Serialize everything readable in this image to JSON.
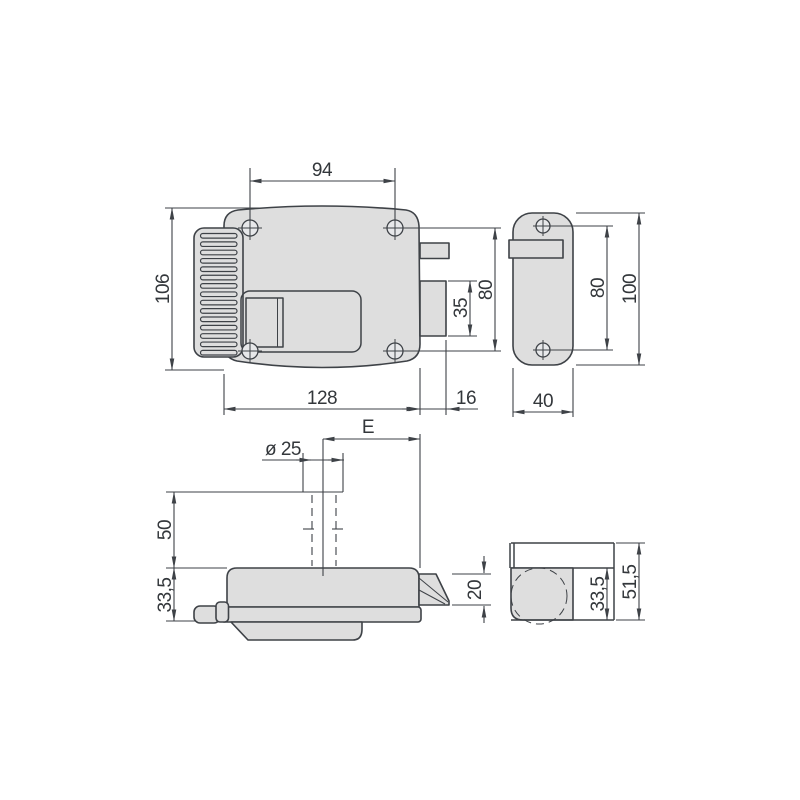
{
  "drawing": {
    "type": "technical-drawing",
    "subject": "electric-rim-lock-with-strike-plate-four-views",
    "colors": {
      "line": "#3e4247",
      "text": "#33373b",
      "body_fill": "#dedede",
      "hole_fill": "#e7e8ea",
      "background": "#ffffff"
    },
    "dimensions": [
      {
        "id": "94",
        "text": "94",
        "x": 322,
        "y": 176,
        "rotated": false
      },
      {
        "id": "106",
        "text": "106",
        "x": 169,
        "y": 289,
        "rotated": true
      },
      {
        "id": "128",
        "text": "128",
        "x": 322,
        "y": 404,
        "rotated": false
      },
      {
        "id": "16",
        "text": "16",
        "x": 466,
        "y": 404,
        "rotated": false
      },
      {
        "id": "35",
        "text": "35",
        "x": 467,
        "y": 308,
        "rotated": true
      },
      {
        "id": "80-lock",
        "text": "80",
        "x": 492,
        "y": 290,
        "rotated": true
      },
      {
        "id": "80-strike",
        "text": "80",
        "x": 604,
        "y": 288,
        "rotated": true
      },
      {
        "id": "100",
        "text": "100",
        "x": 636,
        "y": 289,
        "rotated": true
      },
      {
        "id": "40",
        "text": "40",
        "x": 543,
        "y": 407,
        "rotated": false
      },
      {
        "id": "E",
        "text": "E",
        "x": 368,
        "y": 433,
        "rotated": false
      },
      {
        "id": "dia-25",
        "text": "ø 25",
        "x": 283,
        "y": 455,
        "rotated": false
      },
      {
        "id": "50",
        "text": "50",
        "x": 171,
        "y": 530,
        "rotated": true
      },
      {
        "id": "33-5-lock",
        "text": "33,5",
        "x": 171,
        "y": 595,
        "rotated": true
      },
      {
        "id": "20",
        "text": "20",
        "x": 481,
        "y": 590,
        "rotated": true
      },
      {
        "id": "33-5-strike",
        "text": "33,5",
        "x": 604,
        "y": 594,
        "rotated": true
      },
      {
        "id": "51-5",
        "text": "51,5",
        "x": 636,
        "y": 582,
        "rotated": true
      }
    ],
    "ribs": {
      "count": 15,
      "x": 200.5,
      "width": 36.5,
      "first_y": 233.5,
      "pitch": 8.35,
      "height": 4.6
    }
  }
}
